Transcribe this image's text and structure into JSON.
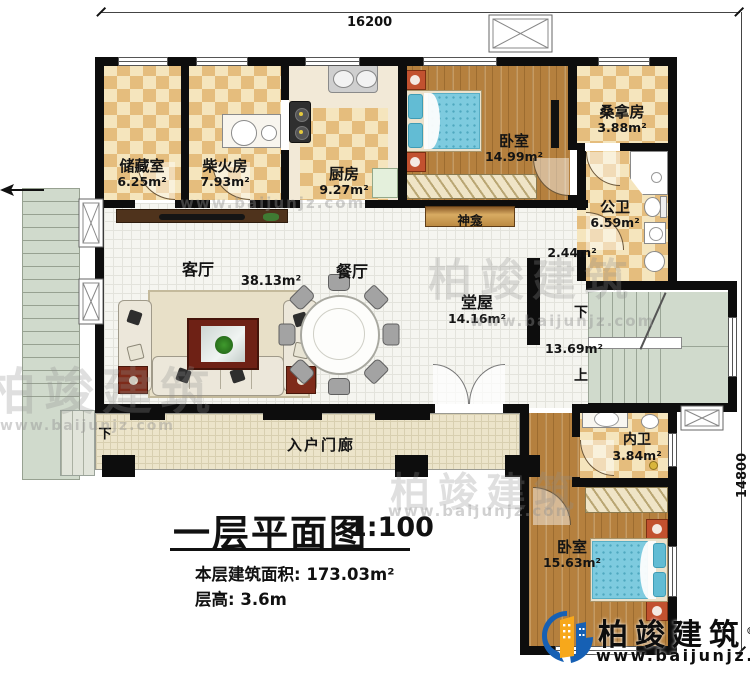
{
  "dimensions": {
    "top": "16200",
    "right": "14800"
  },
  "rooms": {
    "storage": {
      "name": "储藏室",
      "area": "6.25m²"
    },
    "firewood": {
      "name": "柴火房",
      "area": "7.93m²"
    },
    "kitchen": {
      "name": "厨房",
      "area": "9.27m²"
    },
    "bedroom1": {
      "name": "卧室",
      "area": "14.99m²"
    },
    "sauna": {
      "name": "桑拿房",
      "area": "3.88m²"
    },
    "public_bath": {
      "name": "公卫",
      "area": "6.59m²"
    },
    "living": {
      "name": "客厅",
      "area": "38.13m²"
    },
    "dining": {
      "name": "餐厅"
    },
    "shrine": {
      "name": "神龛"
    },
    "hall": {
      "name": "堂屋",
      "area": "14.16m²"
    },
    "niche": {
      "area": "2.44m²"
    },
    "stairwell": {
      "area": "13.69m²"
    },
    "inner_bath": {
      "name": "内卫",
      "area": "3.84m²"
    },
    "bedroom2": {
      "name": "卧室",
      "area": "15.63m²"
    },
    "porch": {
      "name": "入户门廊"
    }
  },
  "stairs": {
    "down": "下",
    "up": "上",
    "porch_down": "下"
  },
  "title": {
    "main": "一层平面图",
    "scale": "1:100",
    "area_line": "本层建筑面积: 173.03m²",
    "height_line": "层高: 3.6m"
  },
  "branding": {
    "company": "柏竣建筑",
    "registered": "®",
    "website": "www.baijunjz.com"
  },
  "watermark": {
    "company": "柏竣建筑",
    "website": "www.baijunjz.com"
  },
  "colors": {
    "accent_blue": "#1660b4",
    "accent_orange": "#f7a81b",
    "wall": "#0d0d0d"
  }
}
